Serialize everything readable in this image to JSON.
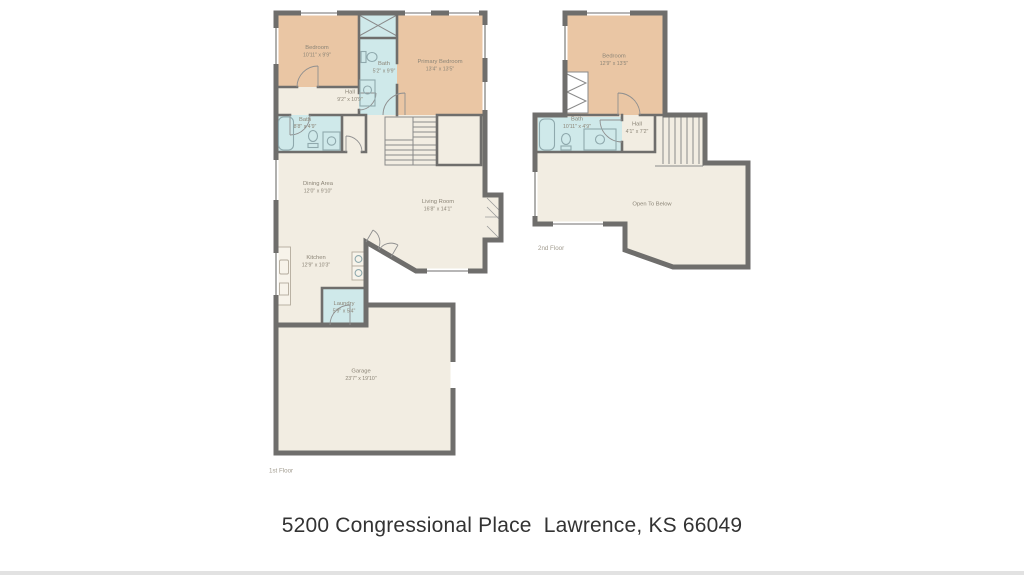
{
  "address": "5200 Congressional Place  Lawrence, KS 66049",
  "floor1": {
    "label": "1st Floor",
    "rooms": {
      "bedroom": {
        "name": "Bedroom",
        "dims": "10'11\" x 9'9\""
      },
      "bath_upper": {
        "name": "Bath",
        "dims": "5'2\" x 9'9\""
      },
      "primary": {
        "name": "Primary Bedroom",
        "dims": "13'4\" x 13'5\""
      },
      "hall": {
        "name": "Hall",
        "dims": "9'2\" x 10'9\""
      },
      "bath_lower": {
        "name": "Bath",
        "dims": "8'8\" x 4'9\""
      },
      "dining": {
        "name": "Dining Area",
        "dims": "12'0\" x 9'10\""
      },
      "living": {
        "name": "Living Room",
        "dims": "16'8\" x 14'1\""
      },
      "kitchen": {
        "name": "Kitchen",
        "dims": "12'9\" x 10'3\""
      },
      "laundry": {
        "name": "Laundry",
        "dims": "5'9\" x 5'4\""
      },
      "garage": {
        "name": "Garage",
        "dims": "23'7\" x 19'10\""
      }
    }
  },
  "floor2": {
    "label": "2nd Floor",
    "rooms": {
      "bedroom": {
        "name": "Bedroom",
        "dims": "12'9\" x 13'5\""
      },
      "bath": {
        "name": "Bath",
        "dims": "10'11\" x 4'9\""
      },
      "hall": {
        "name": "Hall",
        "dims": "4'1\" x 7'2\""
      },
      "open_below": {
        "name": "Open To Below",
        "dims": ""
      }
    }
  },
  "colors": {
    "wall": "#6f6e6c",
    "bedroom_fill": "#eac6a4",
    "bath_fill": "#cfe9ea",
    "room_fill": "#f2ede2",
    "fixture_stroke": "#8fa9ad",
    "label_text": "#8c8577",
    "floor_label_text": "#a09a8e",
    "address_text": "#333333",
    "door_stroke": "#8f8f8f",
    "counter_stroke": "#b3ab9d",
    "background": "#ffffff",
    "footer_strip": "#e2e2e2"
  }
}
